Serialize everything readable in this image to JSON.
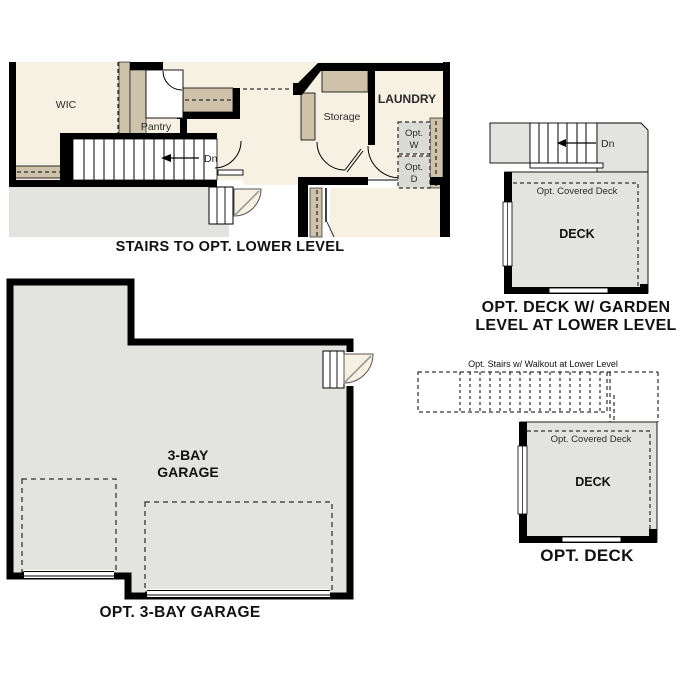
{
  "colors": {
    "floor_cream": "#f7f1e4",
    "cabinet_tan": "#cec2ab",
    "area_gray": "#e3e3df",
    "appliance_gray": "#dadbd4",
    "wall_black": "#000000"
  },
  "plans": {
    "stairs": {
      "caption": "STAIRS TO OPT. LOWER LEVEL",
      "wic": "WIC",
      "pantry": "Pantry",
      "storage": "Storage",
      "laundry": "LAUNDRY",
      "dn": "Dn",
      "opt_w_1": "Opt.",
      "opt_w_2": "W",
      "opt_d_1": "Opt.",
      "opt_d_2": "D"
    },
    "deck_garden": {
      "caption_1": "OPT. DECK W/ GARDEN",
      "caption_2": "LEVEL AT LOWER LEVEL",
      "dn": "Dn",
      "covered": "Opt. Covered Deck",
      "deck": "DECK"
    },
    "garage": {
      "caption": "OPT. 3-BAY GARAGE",
      "label_1": "3-BAY",
      "label_2": "GARAGE"
    },
    "deck": {
      "caption": "OPT. DECK",
      "note": "Opt. Stairs w/ Walkout at Lower Level",
      "covered": "Opt. Covered Deck",
      "deck": "DECK"
    }
  }
}
